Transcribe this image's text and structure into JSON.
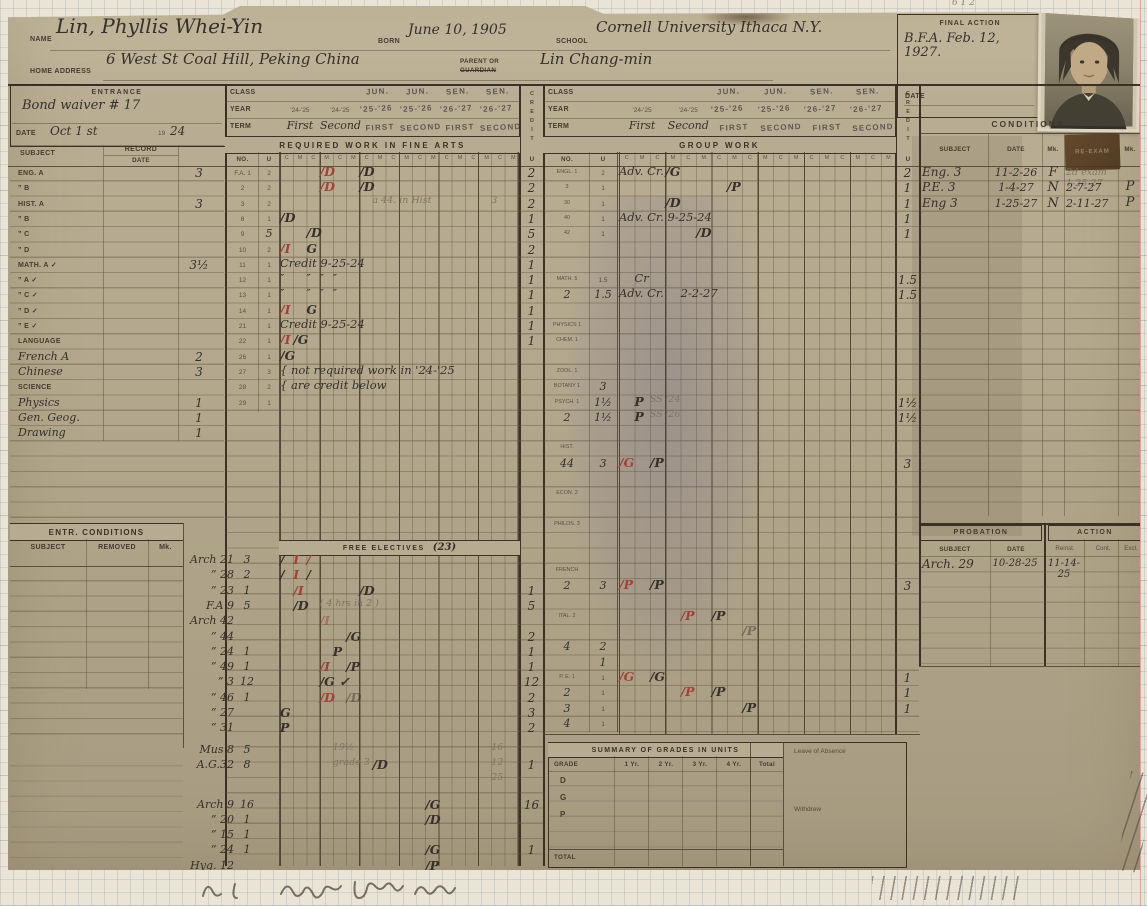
{
  "header": {
    "name_label": "NAME",
    "name_value": "Lin, Phyllis Whei-Yin",
    "born_label": "BORN",
    "born_value": "June 10, 1905",
    "school_label": "SCHOOL",
    "school_value": "Cornell University  Ithaca  N.Y.",
    "home_label": "HOME ADDRESS",
    "home_value": "6 West St  Coal Hill, Peking  China",
    "parent_label_1": "PARENT OR",
    "parent_label_2": "GUARDIAN",
    "parent_value": "Lin Chang-min",
    "final_action_label": "FINAL ACTION",
    "final_action_value": "B.F.A. Feb. 12, 1927.",
    "final_action_date_label": "DATE"
  },
  "entrance": {
    "title": "ENTRANCE",
    "note": "Bond waiver # 17",
    "date_label": "DATE",
    "date_value": "Oct 1 st",
    "year_printed": "19",
    "year_value": "24",
    "col_subject": "SUBJECT",
    "col_record": "RECORD",
    "col_date": "DATE"
  },
  "left_subjects": [
    {
      "label": "ENG. A",
      "units": "3"
    },
    {
      "label": "”  B"
    },
    {
      "label": "HIST. A",
      "units": "3"
    },
    {
      "label": "”  B"
    },
    {
      "label": "”  C"
    },
    {
      "label": "”  D"
    },
    {
      "label": "MATH. A ✓",
      "units": "3½"
    },
    {
      "label": "”  A ✓"
    },
    {
      "label": "”  C ✓"
    },
    {
      "label": "”  D ✓"
    },
    {
      "label": "”  E ✓"
    },
    {
      "label": "LANGUAGE"
    },
    {
      "label": "French A",
      "hand": true,
      "units": "2"
    },
    {
      "label": "Chinese",
      "hand": true,
      "units": "3"
    },
    {
      "label": "SCIENCE"
    },
    {
      "label": "Physics",
      "hand": true,
      "units": "1"
    },
    {
      "label": "Gen. Geog.",
      "hand": true,
      "units": "1"
    },
    {
      "label": "Drawing",
      "hand": true,
      "units": "1"
    }
  ],
  "entr_conditions": {
    "title": "ENTR.  CONDITIONS",
    "col_subject": "SUBJECT",
    "col_removed": "REMOVED",
    "col_mk": "Mk."
  },
  "required": {
    "class_label": "CLASS",
    "year_label": "YEAR",
    "term_label": "TERM",
    "title": "REQUIRED WORK IN FINE ARTS",
    "no_label": "NO.",
    "u_label": "U",
    "c": "C",
    "m": "M",
    "class_stamps": [
      "",
      "",
      "JUN.",
      "JUN.",
      "SEN.",
      "SEN."
    ],
    "years": [
      "'24-'25",
      "'24-'25",
      "'25-'26",
      "'25-'26",
      "'26-'27",
      "'26-'27"
    ],
    "terms": [
      "First",
      "Second",
      "FIRST",
      "SECOND",
      "FIRST",
      "SECOND"
    ],
    "rows": [
      {
        "no": "F.A. 1",
        "u": "2",
        "marks": [
          {
            "c": 3,
            "t": "/D",
            "k": "red"
          },
          {
            "c": 6,
            "t": "/D"
          }
        ]
      },
      {
        "no": "2",
        "u": "2",
        "marks": [
          {
            "c": 3,
            "t": "/D",
            "k": "red"
          },
          {
            "c": 6,
            "t": "/D"
          }
        ]
      },
      {
        "no": "3",
        "u": "2",
        "marks": [
          {
            "c": 7,
            "t": "a 44. in Hist",
            "k": "pencil"
          },
          {
            "c": 16,
            "t": "3",
            "k": "pencil"
          }
        ]
      },
      {
        "no": "8",
        "u": "1",
        "marks": [
          {
            "c": 0,
            "t": "/D"
          }
        ]
      },
      {
        "no": "9",
        "u": "5",
        "uh": true,
        "marks": [
          {
            "c": 2,
            "t": "/D"
          }
        ]
      },
      {
        "no": "10",
        "u": "2",
        "marks": [
          {
            "c": 0,
            "t": "/I",
            "k": "red"
          },
          {
            "c": 2,
            "t": "G"
          }
        ]
      },
      {
        "no": "11",
        "u": "1",
        "marks": [
          {
            "c": 0,
            "t": "Credit  9-25-24",
            "k": "script"
          }
        ]
      },
      {
        "no": "12",
        "u": "1",
        "marks": [
          {
            "c": 0,
            "t": "″",
            "k": "script"
          },
          {
            "c": 2,
            "t": "″",
            "k": "script"
          },
          {
            "c": 3,
            "t": "″",
            "k": "script"
          },
          {
            "c": 4,
            "t": "″",
            "k": "script"
          }
        ]
      },
      {
        "no": "13",
        "u": "1",
        "marks": [
          {
            "c": 0,
            "t": "″",
            "k": "script"
          },
          {
            "c": 2,
            "t": "″",
            "k": "script"
          },
          {
            "c": 3,
            "t": "″",
            "k": "script"
          },
          {
            "c": 4,
            "t": "″",
            "k": "script"
          }
        ]
      },
      {
        "no": "14",
        "u": "1",
        "marks": [
          {
            "c": 0,
            "t": "/I",
            "k": "red"
          },
          {
            "c": 2,
            "t": "G"
          }
        ]
      },
      {
        "no": "21",
        "u": "1",
        "marks": [
          {
            "c": 0,
            "t": "Credit  9-25-24",
            "k": "script"
          }
        ]
      },
      {
        "no": "22",
        "u": "1",
        "marks": [
          {
            "c": 0,
            "t": "/I",
            "k": "red"
          },
          {
            "c": 1,
            "t": "/G"
          }
        ]
      },
      {
        "no": "26",
        "u": "1",
        "marks": [
          {
            "c": 0,
            "t": "/G"
          }
        ]
      },
      {
        "no": "27",
        "u": "3",
        "marks": [
          {
            "c": 0,
            "t": "{ not required work in '24-'25",
            "k": "script"
          }
        ]
      },
      {
        "no": "28",
        "u": "2",
        "marks": [
          {
            "c": 0,
            "t": "{ are credit below",
            "k": "script"
          }
        ]
      },
      {
        "no": "29",
        "u": "1",
        "marks": []
      }
    ]
  },
  "electives": {
    "title": "FREE ELECTIVES",
    "note": "(23)",
    "rows": [
      {
        "course": "Arch 21",
        "u": "3",
        "marks": [
          {
            "c": 0,
            "t": "/"
          },
          {
            "c": 1,
            "t": "I",
            "k": "red"
          },
          {
            "c": 2,
            "t": "/",
            "k": "red"
          }
        ]
      },
      {
        "course": "” 28",
        "u": "2",
        "marks": [
          {
            "c": 0,
            "t": "/"
          },
          {
            "c": 1,
            "t": "I",
            "k": "red"
          },
          {
            "c": 2,
            "t": "/"
          }
        ]
      },
      {
        "course": "” 23",
        "u": "1",
        "marks": [
          {
            "c": 1,
            "t": "/I",
            "k": "red"
          },
          {
            "c": 6,
            "t": "/D"
          }
        ]
      },
      {
        "course": "F.A 9",
        "u": "5",
        "marks": [
          {
            "c": 1,
            "t": "/D"
          },
          {
            "c": 3,
            "t": "( 4 hrs in 2 )",
            "k": "pencil"
          }
        ]
      },
      {
        "course": "Arch 42",
        "u": "",
        "marks": [
          {
            "c": 3,
            "t": "/I",
            "k": "redf"
          }
        ]
      },
      {
        "course": "” 44",
        "u": "",
        "marks": [
          {
            "c": 5,
            "t": "/G"
          }
        ]
      },
      {
        "course": "” 24",
        "u": "1",
        "marks": [
          {
            "c": 4,
            "t": "P"
          }
        ]
      },
      {
        "course": "” 49",
        "u": "1",
        "marks": [
          {
            "c": 3,
            "t": "/I",
            "k": "red"
          },
          {
            "c": 5,
            "t": "/P"
          }
        ]
      },
      {
        "course": "” 3",
        "u": "12",
        "marks": [
          {
            "c": 3,
            "t": "/G ✓"
          }
        ]
      },
      {
        "course": "” 46",
        "u": "1",
        "marks": [
          {
            "c": 3,
            "t": "/D",
            "k": "red"
          },
          {
            "c": 5,
            "t": "/D",
            "k": "faint"
          }
        ]
      },
      {
        "course": "” 27",
        "u": "",
        "marks": [
          {
            "c": 0,
            "t": "G"
          }
        ]
      },
      {
        "course": "” 31",
        "u": "",
        "marks": [
          {
            "c": 0,
            "t": "P"
          }
        ]
      },
      {
        "course": "Mus 8",
        "u": "5",
        "g": 6,
        "marks": [
          {
            "c": 4,
            "t": "19½",
            "k": "pencil"
          },
          {
            "c": 8,
            "t": "⋯",
            "k": "pencil"
          },
          {
            "c": 16,
            "t": "16",
            "k": "pencil"
          }
        ]
      },
      {
        "course": "A.G.32",
        "u": "8",
        "marks": [
          {
            "c": 4,
            "t": "grade 3",
            "k": "pencil"
          },
          {
            "c": 7,
            "t": "/D"
          },
          {
            "c": 16,
            "t": "12",
            "k": "pencil"
          }
        ]
      },
      {
        "course": "",
        "u": "",
        "marks": [
          {
            "c": 16,
            "t": "25",
            "k": "pencil"
          }
        ]
      },
      {
        "course": "Arch 9",
        "u": "16",
        "g": 9,
        "marks": [
          {
            "c": 11,
            "t": "/G"
          }
        ]
      },
      {
        "course": "” 20",
        "u": "1",
        "marks": [
          {
            "c": 11,
            "t": "/D"
          }
        ]
      },
      {
        "course": "” 15",
        "u": "1",
        "marks": []
      },
      {
        "course": "” 24",
        "u": "1",
        "marks": [
          {
            "c": 11,
            "t": "/G"
          }
        ]
      },
      {
        "course": "Hyg. 12",
        "u": "",
        "marks": [
          {
            "c": 11,
            "t": "/P"
          }
        ]
      }
    ]
  },
  "credit_left": {
    "vertical": "CREDIT",
    "u": "U",
    "req": [
      {
        "i": 0,
        "t": "2"
      },
      {
        "i": 1,
        "t": "2"
      },
      {
        "i": 2,
        "t": "2"
      },
      {
        "i": 3,
        "t": "1"
      },
      {
        "i": 4,
        "t": "5"
      },
      {
        "i": 5,
        "t": "2"
      },
      {
        "i": 6,
        "t": "1"
      },
      {
        "i": 7,
        "t": "1"
      },
      {
        "i": 8,
        "t": "1"
      },
      {
        "i": 9,
        "t": "1"
      },
      {
        "i": 10,
        "t": "1"
      },
      {
        "i": 11,
        "t": "1"
      }
    ],
    "elect": [
      {
        "e": 2,
        "t": "1"
      },
      {
        "e": 3,
        "t": "5"
      },
      {
        "e": 5,
        "t": "2"
      },
      {
        "e": 6,
        "t": "1"
      },
      {
        "e": 7,
        "t": "1"
      },
      {
        "e": 8,
        "t": "12"
      },
      {
        "e": 9,
        "t": "2"
      },
      {
        "e": 10,
        "t": "3"
      },
      {
        "e": 11,
        "t": "2"
      },
      {
        "e": 13,
        "t": "1"
      },
      {
        "e": 15,
        "t": "16"
      },
      {
        "e": 18,
        "t": "1"
      }
    ]
  },
  "group": {
    "class_label": "CLASS",
    "year_label": "YEAR",
    "term_label": "TERM",
    "title": "GROUP WORK",
    "no_label": "NO.",
    "u_label": "U",
    "class_stamps": [
      "",
      "",
      "JUN.",
      "JUN.",
      "SEN.",
      "SEN."
    ],
    "years": [
      "'24-'25",
      "'24-'25",
      "'25-'26",
      "'25-'26",
      "'26-'27",
      "'26-'27"
    ],
    "terms": [
      "First",
      "Second",
      "FIRST",
      "SECOND",
      "FIRST",
      "SECOND"
    ],
    "rows": [
      {
        "ri": 0,
        "no": "ENGL. 1",
        "u": "2",
        "marks": [
          {
            "c": 0,
            "t": "Adv. Cr.",
            "k": "script"
          },
          {
            "c": 3,
            "t": "/G"
          }
        ]
      },
      {
        "ri": 1,
        "no": "3",
        "u": "1",
        "marks": [
          {
            "c": 7,
            "t": "/P"
          }
        ]
      },
      {
        "ri": 2,
        "no": "30",
        "u": "1",
        "marks": [
          {
            "c": 3,
            "t": "/D"
          }
        ]
      },
      {
        "ri": 3,
        "no": "40",
        "u": "1",
        "marks": [
          {
            "c": 0,
            "t": "Adv. Cr.  9-25-24",
            "k": "script"
          }
        ]
      },
      {
        "ri": 4,
        "no": "42",
        "u": "1",
        "marks": [
          {
            "c": 5,
            "t": "/D"
          }
        ]
      },
      {
        "ri": 7,
        "no": "MATH. 5",
        "u": "1.5",
        "marks": [
          {
            "c": 1,
            "t": "Cr",
            "k": "script"
          }
        ]
      },
      {
        "ri": 8,
        "no": "2",
        "nh": true,
        "u": "1.5",
        "uh": true,
        "marks": [
          {
            "c": 0,
            "t": "Adv. Cr.",
            "k": "script"
          },
          {
            "c": 4,
            "t": "2-2-27",
            "k": "script"
          }
        ]
      },
      {
        "ri": 10,
        "no": "PHYSICS 1",
        "u": "",
        "marks": []
      },
      {
        "ri": 11,
        "no": "CHEM. 1",
        "u": "",
        "marks": []
      },
      {
        "ri": 13,
        "no": "ZOOL. 1",
        "u": "",
        "marks": []
      },
      {
        "ri": 14,
        "no": "BOTANY 1",
        "u": "3",
        "uh": true,
        "marks": []
      },
      {
        "ri": 15,
        "no": "PSYCH. 1",
        "u": "1½",
        "uh": true,
        "marks": [
          {
            "c": 1,
            "t": "P"
          },
          {
            "c": 2,
            "t": "SS '24",
            "k": "pencil"
          }
        ]
      },
      {
        "ri": 16,
        "no": "2",
        "nh": true,
        "u": "1½",
        "uh": true,
        "marks": [
          {
            "c": 1,
            "t": "P"
          },
          {
            "c": 2,
            "t": "SS '26",
            "k": "pencil"
          }
        ]
      },
      {
        "ri": 18,
        "no": "HIST.",
        "u": "",
        "marks": []
      },
      {
        "ri": 19,
        "no": "44",
        "nh": true,
        "u": "3",
        "uh": true,
        "marks": [
          {
            "c": 0,
            "t": "/G",
            "k": "red"
          },
          {
            "c": 2,
            "t": "/P"
          }
        ]
      },
      {
        "ri": 21,
        "no": "ECON. 2",
        "u": "",
        "marks": []
      },
      {
        "ri": 23,
        "no": "PHILOS. 3",
        "u": "",
        "marks": []
      },
      {
        "ri": 26,
        "no": "FRENCH",
        "u": "",
        "marks": []
      },
      {
        "ri": 27,
        "no": "2",
        "nh": true,
        "u": "3",
        "uh": true,
        "marks": [
          {
            "c": 0,
            "t": "/P",
            "k": "red"
          },
          {
            "c": 2,
            "t": "/P"
          }
        ]
      },
      {
        "ri": 29,
        "no": "ITAL. 2",
        "u": "",
        "marks": [
          {
            "c": 4,
            "t": "/P",
            "k": "red"
          },
          {
            "c": 6,
            "t": "/P"
          }
        ]
      },
      {
        "ri": 30,
        "no": "",
        "u": "",
        "marks": [
          {
            "c": 8,
            "t": "/P",
            "k": "faint"
          }
        ]
      },
      {
        "ri": 31,
        "no": "4",
        "nh": true,
        "u": "2",
        "uh": true,
        "marks": []
      },
      {
        "ri": 32,
        "no": "",
        "u": "1",
        "uh": true,
        "marks": []
      },
      {
        "ri": 33,
        "no": "P. E. 1",
        "u": "1",
        "marks": [
          {
            "c": 0,
            "t": "/G",
            "k": "red"
          },
          {
            "c": 2,
            "t": "/G"
          }
        ]
      },
      {
        "ri": 34,
        "no": "2",
        "nh": true,
        "u": "1",
        "marks": [
          {
            "c": 4,
            "t": "/P",
            "k": "red"
          },
          {
            "c": 6,
            "t": "/P"
          }
        ]
      },
      {
        "ri": 35,
        "no": "3",
        "nh": true,
        "u": "1",
        "marks": [
          {
            "c": 8,
            "t": "/P"
          }
        ]
      },
      {
        "ri": 36,
        "no": "4",
        "nh": true,
        "u": "1",
        "marks": []
      }
    ]
  },
  "credit_right": {
    "vertical": "CREDIT",
    "u": "U",
    "vals": [
      {
        "ri": 0,
        "t": "2"
      },
      {
        "ri": 1,
        "t": "1"
      },
      {
        "ri": 2,
        "t": "1"
      },
      {
        "ri": 3,
        "t": "1"
      },
      {
        "ri": 4,
        "t": "1"
      },
      {
        "ri": 7,
        "t": "1.5"
      },
      {
        "ri": 8,
        "t": "1.5"
      },
      {
        "ri": 15,
        "t": "1½"
      },
      {
        "ri": 16,
        "t": "1½"
      },
      {
        "ri": 19,
        "t": "3"
      },
      {
        "ri": 27,
        "t": "3"
      },
      {
        "ri": 33,
        "t": "1"
      },
      {
        "ri": 34,
        "t": "1"
      },
      {
        "ri": 35,
        "t": "1"
      }
    ]
  },
  "conditions": {
    "title": "CONDITIONS",
    "col_subject": "SUBJECT",
    "col_date": "DATE",
    "col_mk": "Mk.",
    "col_reexam": "RE-EXAM",
    "col_mk2": "Mk.",
    "rows": [
      {
        "subject": "Eng. 3",
        "date": "11-2-26",
        "mk": "F",
        "re": "2d exam 1-25-27",
        "rp": true,
        "mk2": ""
      },
      {
        "subject": "P.E. 3",
        "date": "1-4-27",
        "mk": "N",
        "re": "2-7-27",
        "mk2": "P"
      },
      {
        "subject": "Eng 3",
        "date": "1-25-27",
        "mk": "N",
        "re": "2-11-27",
        "mk2": "P"
      }
    ]
  },
  "probation": {
    "title_left": "PROBATION",
    "title_right": "ACTION",
    "col_subject": "SUBJECT",
    "col_date": "DATE",
    "col_reinst": "Reinst.",
    "col_cont": "Cont.",
    "col_excl": "Excl.",
    "rows": [
      {
        "subject": "Arch. 29",
        "date": "10-28-25",
        "reinst": "11-14-25",
        "cont": "",
        "excl": ""
      }
    ]
  },
  "summary": {
    "title": "SUMMARY OF GRADES IN UNITS",
    "columns": [
      "GRADE",
      "1 Yr.",
      "2 Yr.",
      "3 Yr.",
      "4 Yr.",
      "Total"
    ],
    "rows": [
      "D",
      "G",
      "P"
    ],
    "total_label": "TOTAL",
    "leave_label": "Leave of Absence",
    "withdrew_label": "Withdrew"
  },
  "margins": {
    "top_right_pencil": "6 1 2",
    "bottom_script": "illegible pencil inscription"
  }
}
